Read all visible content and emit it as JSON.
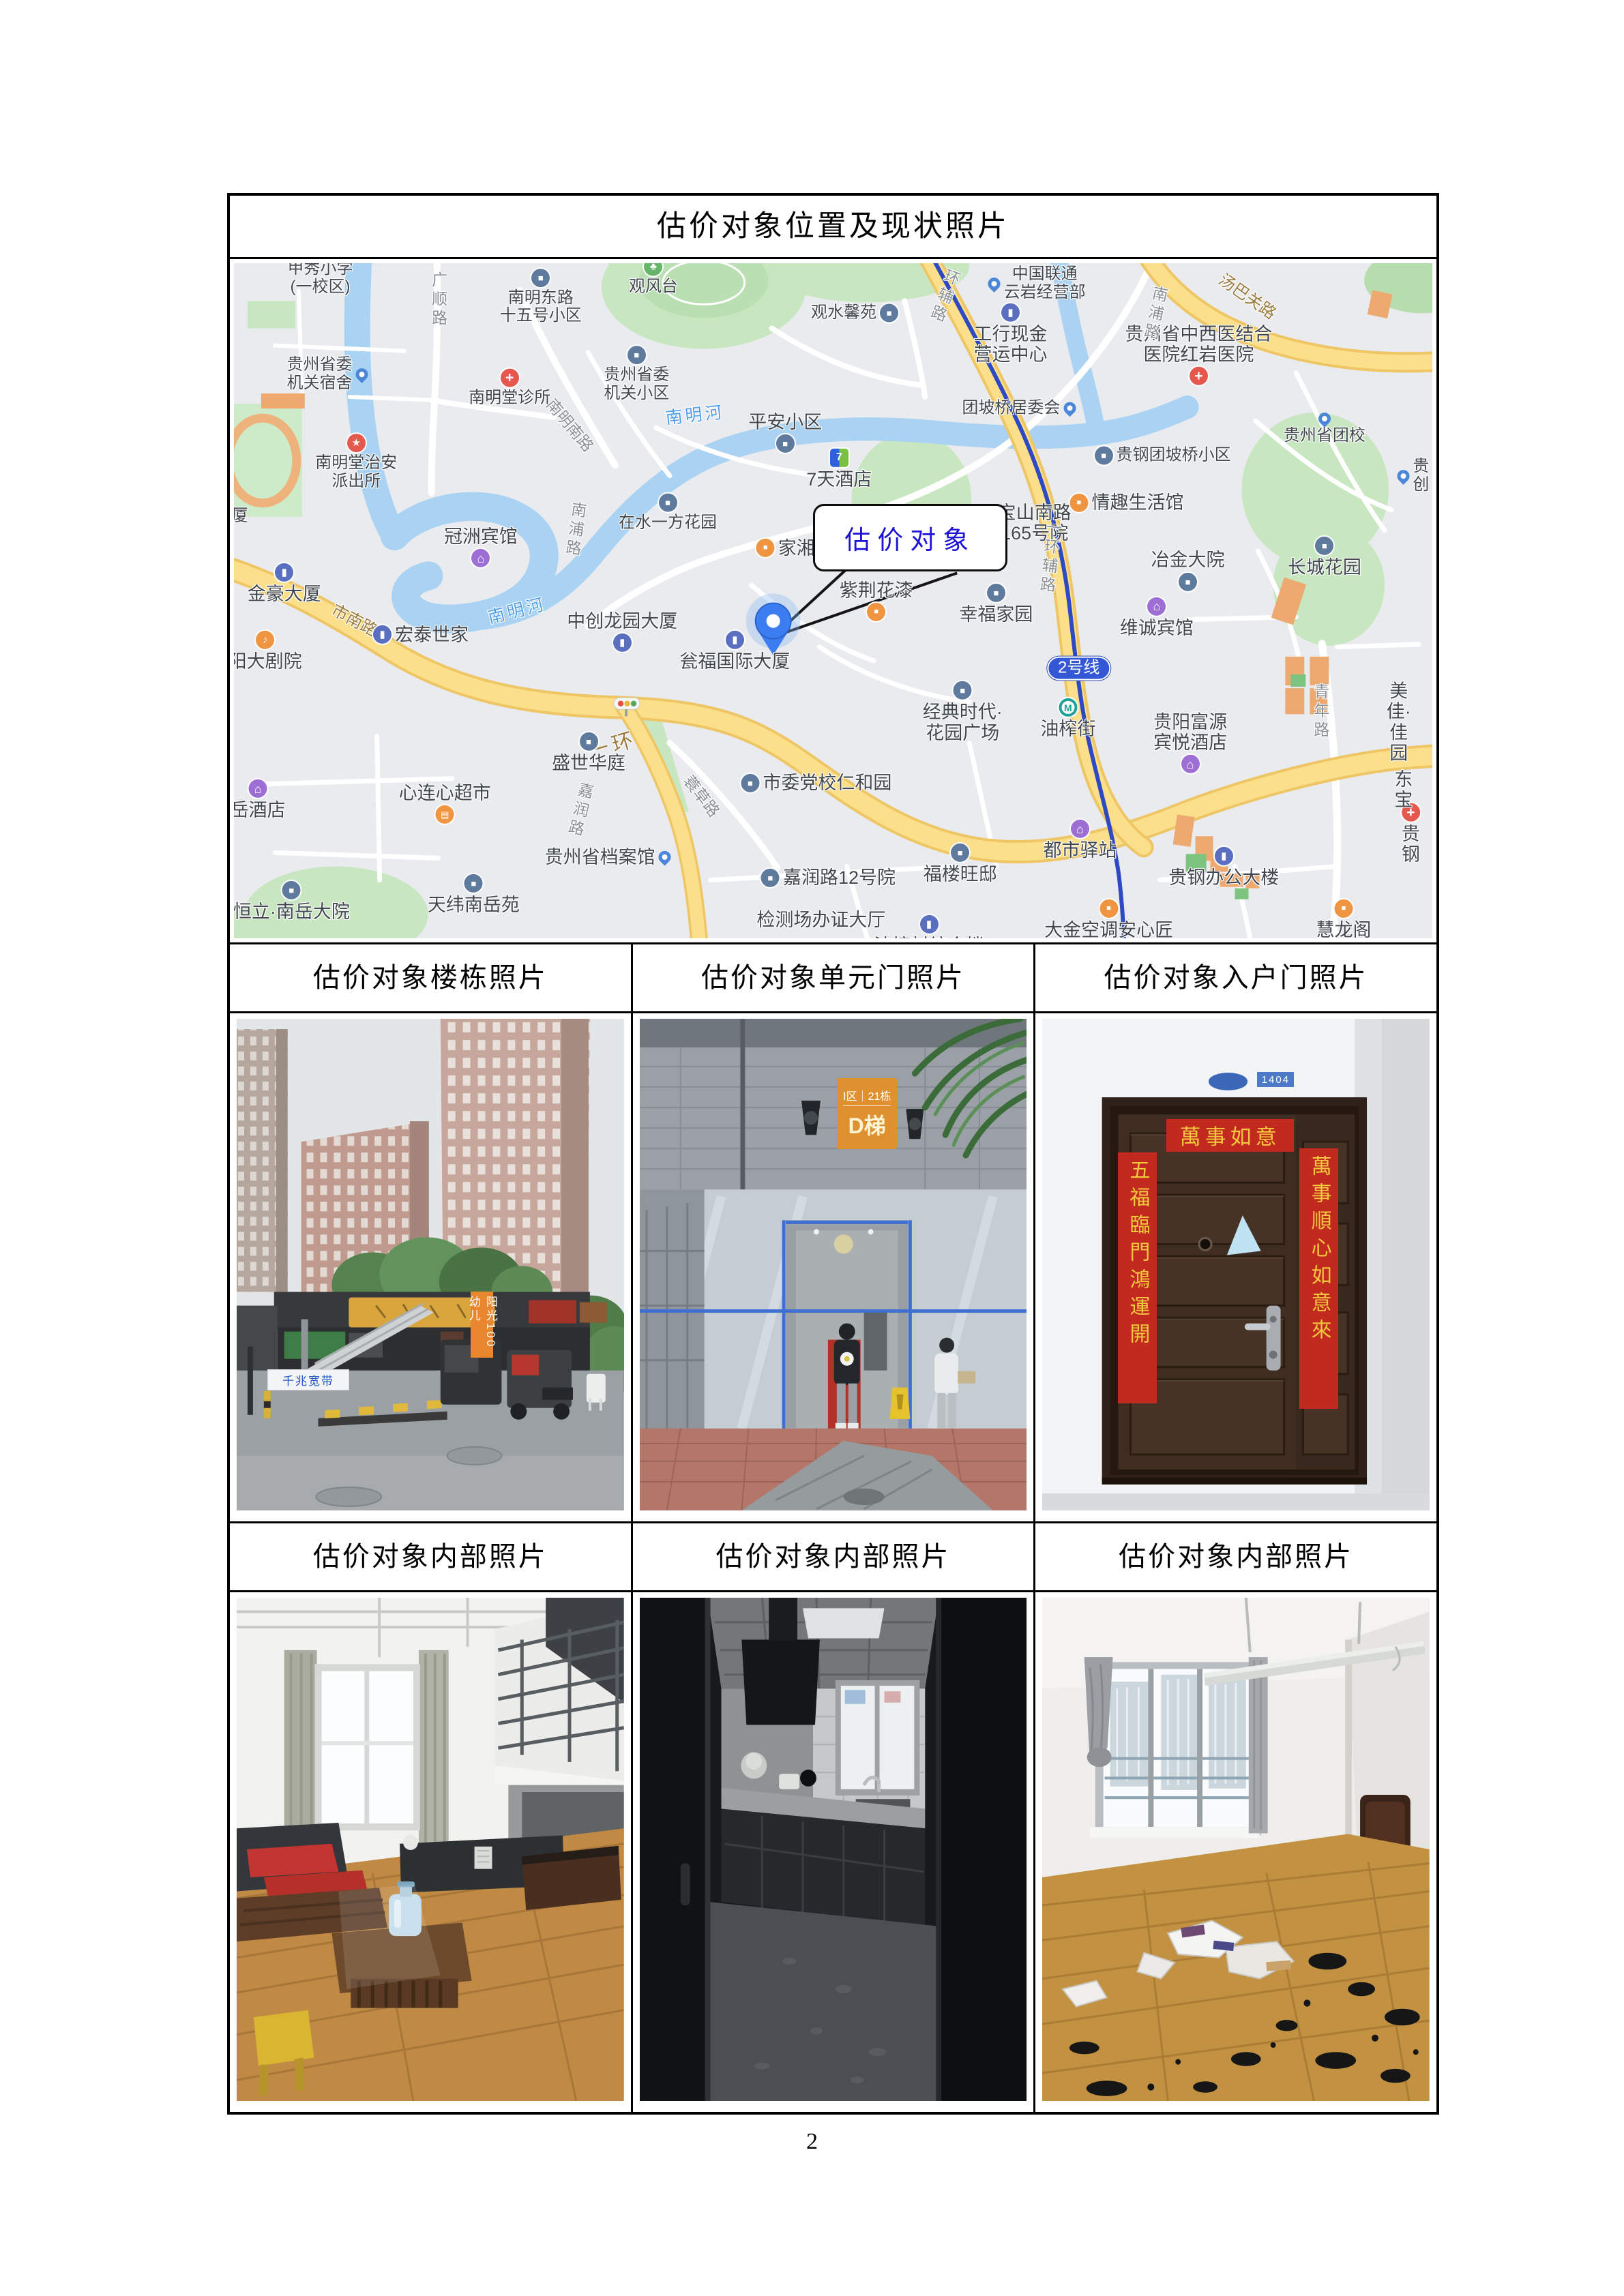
{
  "page": {
    "number": "2"
  },
  "table": {
    "title": "估价对象位置及现状照片",
    "row_headers_top": [
      "估价对象楼栋照片",
      "估价对象单元门照片",
      "估价对象入户门照片"
    ],
    "row_headers_bottom": [
      "估价对象内部照片",
      "估价对象内部照片",
      "估价对象内部照片"
    ]
  },
  "map": {
    "callout_label": "估价对象",
    "colors": {
      "road_major": "#f8d87a",
      "water": "#aad3f3",
      "park": "#c8e6c0",
      "metro_line": "#2e49c4",
      "callout_text": "#1d12d6",
      "pin": "#3d7df2"
    },
    "labels": [
      {
        "t": "甲秀小学\n(一校区)",
        "x": 7.2,
        "y": 2.2,
        "c": "place"
      },
      {
        "t": "广顺路",
        "x": 17,
        "y": 5.5,
        "c": "road vert"
      },
      {
        "t": "南明东路\n十五号小区",
        "x": 25.6,
        "y": 5,
        "c": "place",
        "i": "bus",
        "p": "top"
      },
      {
        "t": "观风台",
        "x": 35,
        "y": 2,
        "c": "place",
        "i": "park",
        "p": "top"
      },
      {
        "t": "观水馨苑",
        "x": 51.8,
        "y": 7.4,
        "c": "place",
        "i": "bus",
        "p": "right"
      },
      {
        "t": "中国联通\n云岩经营部",
        "x": 67,
        "y": 3,
        "c": "place",
        "i": "pin",
        "p": "left"
      },
      {
        "t": "工行现金\n营运中心",
        "x": 64.8,
        "y": 10.5,
        "c": "place lg",
        "i": "co",
        "p": "top"
      },
      {
        "t": "贵州省委\n机关小区",
        "x": 33.6,
        "y": 16.5,
        "c": "place",
        "i": "bus",
        "p": "top"
      },
      {
        "t": "贵州省委\n机关宿舍",
        "x": 7.8,
        "y": 16.5,
        "c": "place",
        "i": "pin",
        "p": "right"
      },
      {
        "t": "南明堂诊所",
        "x": 23,
        "y": 18.5,
        "c": "place",
        "i": "hosp",
        "p": "top"
      },
      {
        "t": "南明堂治安\n派出所",
        "x": 10.2,
        "y": 29.5,
        "c": "place",
        "i": "police",
        "p": "top"
      },
      {
        "t": "南明南路",
        "x": 28,
        "y": 24,
        "c": "road",
        "r": 50
      },
      {
        "t": "南明河",
        "x": 38.5,
        "y": 22.5,
        "c": "water",
        "r": -6
      },
      {
        "t": "平安小区",
        "x": 46,
        "y": 25,
        "c": "place lg",
        "i": "bus",
        "p": "bottom"
      },
      {
        "t": "7天酒店",
        "x": 50.5,
        "y": 30.5,
        "c": "place lg",
        "i": "seven",
        "p": "top"
      },
      {
        "t": "团坡桥居委会",
        "x": 65.5,
        "y": 21.5,
        "c": "place",
        "i": "pin",
        "p": "right"
      },
      {
        "t": "贵州省中西医结合\n医院红岩医院",
        "x": 80.5,
        "y": 13.5,
        "c": "place lg",
        "i": "hosp",
        "p": "bottom"
      },
      {
        "t": "贵钢团坡桥小区",
        "x": 77.5,
        "y": 28.5,
        "c": "place",
        "i": "bus",
        "p": "left"
      },
      {
        "t": "贵州省团校",
        "x": 91,
        "y": 24.5,
        "c": "place",
        "i": "pin",
        "p": "top"
      },
      {
        "t": "情趣生活馆",
        "x": 74.5,
        "y": 35.5,
        "c": "place lg",
        "i": "shop",
        "p": "left"
      },
      {
        "t": "汤巴关路",
        "x": 84.5,
        "y": 5,
        "c": "road-y",
        "r": 35
      },
      {
        "t": "南浦路",
        "x": 76.8,
        "y": 7.5,
        "c": "road vert",
        "r": 12
      },
      {
        "t": "南浦路",
        "x": 28.4,
        "y": 39.5,
        "c": "road vert",
        "r": 8
      },
      {
        "t": "在水一方花园",
        "x": 36.2,
        "y": 37,
        "c": "place",
        "i": "bus",
        "p": "top"
      },
      {
        "t": "冠洲宾馆",
        "x": 20.6,
        "y": 42,
        "c": "place lg",
        "i": "hotel",
        "p": "bottom"
      },
      {
        "t": "金豪大厦",
        "x": 4.2,
        "y": 47.5,
        "c": "place lg",
        "i": "co",
        "p": "top"
      },
      {
        "t": "市南路",
        "x": 10,
        "y": 53,
        "c": "road-y",
        "r": 28
      },
      {
        "t": "阳大剧院",
        "x": 2.6,
        "y": 57.5,
        "c": "place lg",
        "i": "music",
        "p": "top"
      },
      {
        "t": "宏泰世家",
        "x": 15.6,
        "y": 55,
        "c": "place lg",
        "i": "co",
        "p": "left"
      },
      {
        "t": "南明河",
        "x": 23.6,
        "y": 51.5,
        "c": "water",
        "r": -14
      },
      {
        "t": "中创龙园大厦",
        "x": 32.4,
        "y": 54.5,
        "c": "place lg",
        "i": "co",
        "p": "bottom"
      },
      {
        "t": "瓮福国际大厦",
        "x": 41.8,
        "y": 57.5,
        "c": "place lg",
        "i": "co",
        "p": "top"
      },
      {
        "t": "家湘美",
        "x": 46.8,
        "y": 42.2,
        "c": "place lg",
        "i": "shop",
        "p": "left"
      },
      {
        "t": "宝山南路\n165号院",
        "x": 66.8,
        "y": 38.5,
        "c": "place lg"
      },
      {
        "t": "紫荆花漆",
        "x": 53.6,
        "y": 50,
        "c": "place lg",
        "i": "shop",
        "p": "bottom"
      },
      {
        "t": "幸福家园",
        "x": 63.6,
        "y": 50.5,
        "c": "place lg",
        "i": "bus",
        "p": "top"
      },
      {
        "t": "经典时代·\n花园广场",
        "x": 60.8,
        "y": 66.5,
        "c": "place lg",
        "i": "bus",
        "p": "top"
      },
      {
        "t": "一环辅路",
        "x": 59.5,
        "y": 3.5,
        "c": "road vert",
        "r": 20
      },
      {
        "t": "一环辅路",
        "x": 68,
        "y": 43.5,
        "c": "road vert",
        "r": 6
      },
      {
        "t": "一环",
        "x": 31.6,
        "y": 71.5,
        "c": "road-y lg",
        "r": -16
      },
      {
        "t": "2号线",
        "x": 70.5,
        "y": 60,
        "c": "metro-badge"
      },
      {
        "t": "油榨街",
        "x": 69.6,
        "y": 67.5,
        "c": "place lg",
        "i": "metro",
        "p": "top"
      },
      {
        "t": "冶金大院",
        "x": 79.6,
        "y": 45.5,
        "c": "place lg",
        "i": "bus",
        "p": "bottom"
      },
      {
        "t": "维诚宾馆",
        "x": 77,
        "y": 52.5,
        "c": "place lg",
        "i": "hotel",
        "p": "top"
      },
      {
        "t": "长城花园",
        "x": 91,
        "y": 43.5,
        "c": "place lg",
        "i": "bus",
        "p": "top"
      },
      {
        "t": "青年路",
        "x": 90.6,
        "y": 66.5,
        "c": "road vert"
      },
      {
        "t": "美佳·佳园",
        "x": 97.2,
        "y": 68,
        "c": "place lg"
      },
      {
        "t": "贵阳富源\n宾悦酒店",
        "x": 79.8,
        "y": 71,
        "c": "place lg",
        "i": "hotel",
        "p": "bottom"
      },
      {
        "t": "盛世华庭",
        "x": 29.6,
        "y": 72.5,
        "c": "place lg",
        "i": "bus",
        "p": "top"
      },
      {
        "t": "嘉润路",
        "x": 28.8,
        "y": 81,
        "c": "road vert",
        "r": 14
      },
      {
        "t": "市委党校仁和园",
        "x": 48.6,
        "y": 77,
        "c": "place lg",
        "i": "bus",
        "p": "left"
      },
      {
        "t": "蓑草路",
        "x": 39,
        "y": 79,
        "c": "road",
        "r": 52
      },
      {
        "t": "岳酒店",
        "x": 2,
        "y": 79.5,
        "c": "place lg",
        "i": "hotel",
        "p": "top"
      },
      {
        "t": "心连心超市",
        "x": 17.6,
        "y": 80,
        "c": "place lg",
        "i": "cart",
        "p": "bottom"
      },
      {
        "t": "贵州省档案馆",
        "x": 31.2,
        "y": 88,
        "c": "place lg",
        "i": "pin",
        "p": "right"
      },
      {
        "t": "嘉润路12号院",
        "x": 49.6,
        "y": 91,
        "c": "place lg",
        "i": "bus",
        "p": "left"
      },
      {
        "t": "恒立·南岳大院",
        "x": 4.8,
        "y": 94.5,
        "c": "place lg",
        "i": "bus",
        "p": "top"
      },
      {
        "t": "天纬南岳苑",
        "x": 20,
        "y": 93.5,
        "c": "place lg",
        "i": "bus",
        "p": "top"
      },
      {
        "t": "检测场办证大厅",
        "x": 49,
        "y": 97.3,
        "c": "place lg"
      },
      {
        "t": "大金空调安心匠",
        "x": 73,
        "y": 97.3,
        "c": "place lg",
        "i": "shop",
        "p": "top"
      },
      {
        "t": "慧龙阁",
        "x": 92.6,
        "y": 97.3,
        "c": "place lg",
        "i": "shop",
        "p": "top"
      },
      {
        "t": "都市驿站",
        "x": 70.6,
        "y": 85.5,
        "c": "place lg",
        "i": "hotel",
        "p": "top"
      },
      {
        "t": "福楼旺邸",
        "x": 60.6,
        "y": 89,
        "c": "place lg",
        "i": "bus",
        "p": "top"
      },
      {
        "t": "贵钢办公大楼",
        "x": 82.6,
        "y": 89.5,
        "c": "place lg",
        "i": "co",
        "p": "top"
      },
      {
        "t": "贵钢",
        "x": 98.2,
        "y": 84.5,
        "c": "place lg",
        "i": "hosp",
        "p": "top"
      },
      {
        "t": "东宝",
        "x": 97.6,
        "y": 78,
        "c": "place lg"
      },
      {
        "t": "油榨村综合楼",
        "x": 58,
        "y": 99.6,
        "c": "place lg",
        "i": "co",
        "p": "top"
      },
      {
        "t": "厦",
        "x": 0.5,
        "y": 37.5,
        "c": "place"
      },
      {
        "t": "贵创",
        "x": 98.4,
        "y": 31.5,
        "c": "place",
        "i": "pin",
        "p": "left"
      }
    ]
  },
  "photos": {
    "building": {
      "vertical_sign": "阳光100幼儿",
      "banner": "千兆宽带"
    },
    "entrance": {
      "sign_zone": "Ⅰ区",
      "sign_building": "21栋",
      "sign_unit": "D梯"
    },
    "door": {
      "banner": "萬事如意",
      "couplet_left": "五福臨門鴻運開",
      "couplet_right": "萬事順心如意來",
      "plate": "1404"
    }
  }
}
